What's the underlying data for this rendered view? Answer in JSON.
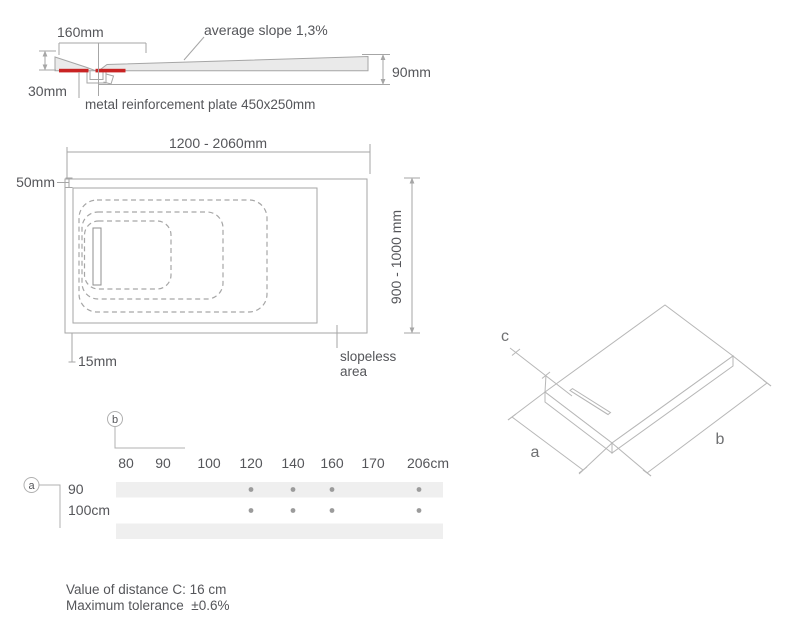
{
  "colors": {
    "outline": "#a6a6a6",
    "iso_outline": "#b7b7b7",
    "body_fill": "#eaeaea",
    "reinforcement_red": "#c92323",
    "text": "#55565a",
    "band": "#efefef",
    "dot": "#9b9b9b"
  },
  "cross_section": {
    "dim_top": "160mm",
    "slope_label": "average slope 1,3%",
    "dim_right": "90mm",
    "dim_left": "30mm",
    "plate_label": "metal reinforcement plate 450x250mm"
  },
  "plan_view": {
    "dim_width": "1200 - 2060mm",
    "dim_border_top": "50mm",
    "dim_depth": "900 - 1000 mm",
    "dim_border_left": "15mm",
    "slopeless_line1": "slopeless",
    "slopeless_line2": "area"
  },
  "iso_view": {
    "label_a": "a",
    "label_b": "b",
    "label_c": "c"
  },
  "size_table": {
    "axis_b": "b",
    "axis_a": "a"
  },
  "chart_data": {
    "type": "table",
    "title": "shower tray size availability matrix",
    "columns": [
      "80",
      "90",
      "100",
      "120",
      "140",
      "160",
      "170",
      "206cm"
    ],
    "rows": [
      {
        "label": "90",
        "dots": [
          false,
          false,
          false,
          true,
          true,
          true,
          false,
          true
        ]
      },
      {
        "label": "100cm",
        "dots": [
          false,
          false,
          false,
          true,
          true,
          true,
          false,
          true
        ]
      }
    ]
  },
  "notes": {
    "line1": "Value of distance C: 16 cm",
    "line2": "Maximum tolerance  ±0.6%"
  }
}
